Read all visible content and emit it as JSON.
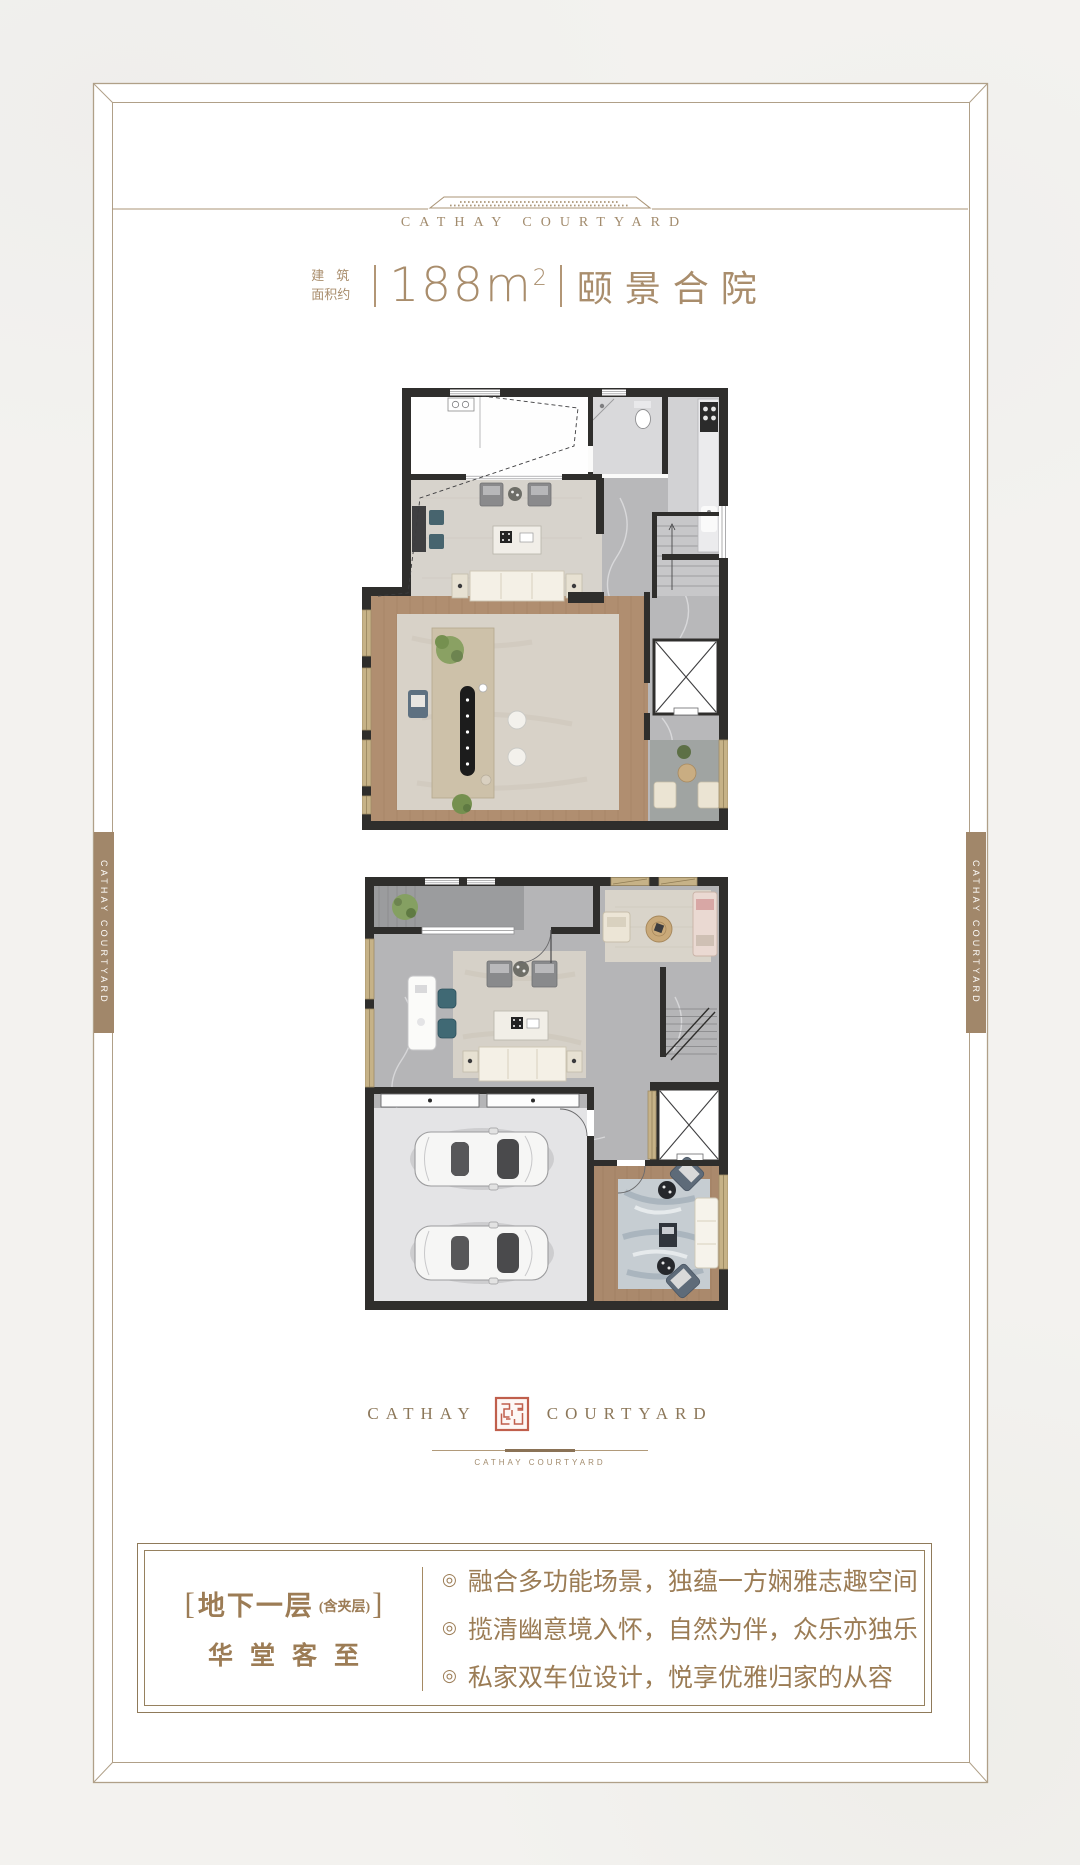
{
  "brand": {
    "header_logo": "CATHAY COURTYARD",
    "side_tab_text": "CATHAY COURTYARD",
    "footer_logo_left": "CATHAY",
    "footer_logo_right": "COURTYARD",
    "footer_sublogo": "CATHAY COURTYARD"
  },
  "title": {
    "prefix_line1": "建筑",
    "prefix_line2": "面积约",
    "area_value": "188",
    "area_unit": "m",
    "area_sup": "2",
    "product_name": "颐景合院"
  },
  "info_box": {
    "bracket_open": "[",
    "floor_label": "地下一层",
    "floor_note": "(含夹层)",
    "bracket_close": "]",
    "floor_tagline": "华堂客至",
    "bullet_symbol": "◎",
    "bullets": [
      {
        "text": "融合多功能场景，独蕴一方娴雅志趣空间"
      },
      {
        "text": "揽清幽意境入怀，自然为伴，众乐亦独乐"
      },
      {
        "text": "私家双车位设计，悦享优雅归家的从容"
      }
    ]
  },
  "colors": {
    "accent_bronze": "#a98d6c",
    "frame_line": "#b0a088",
    "tab_brown": "#a1876a",
    "seal_red": "#c05f4c",
    "info_text": "#9b7c55",
    "wall_dark": "#2f2e2c",
    "paper": "#f3f2ef"
  }
}
